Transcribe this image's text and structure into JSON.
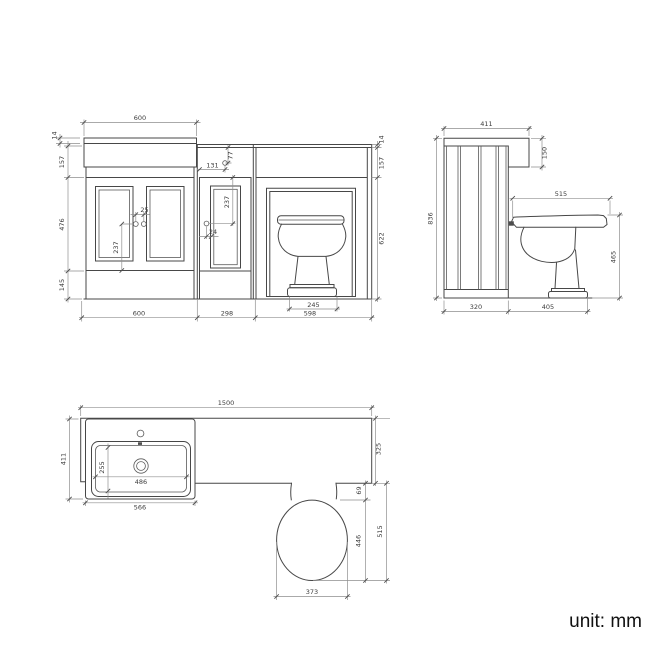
{
  "drawing": {
    "unit_label": "unit: mm",
    "front_view": {
      "top_counter_width": "600",
      "counter_thickness_left": "14",
      "upstand_height": "157",
      "door_zone_height": "476",
      "plinth_height": "145",
      "knob_spacing": "25",
      "knob_to_plinth": "237",
      "mid_knob_offset_h": "131",
      "mid_knob_offset_v": "77",
      "mid_door_knob_drop": "237",
      "mid_knob_edge_offset": "24",
      "counter_thickness_right": "14",
      "counter_band_right": "157",
      "body_height_right": "622",
      "toilet_base_width": "245",
      "section_width_left": "600",
      "section_width_mid": "298",
      "section_width_right": "598"
    },
    "side_view": {
      "counter_depth": "411",
      "counter_return_drop": "150",
      "overall_height": "836",
      "seat_projection": "515",
      "seat_height": "465",
      "panel_depth": "320",
      "toilet_zone_depth": "405"
    },
    "plan_view": {
      "overall_width": "1500",
      "basin_unit_depth": "411",
      "basin_inner_depth": "255",
      "basin_inner_width": "486",
      "basin_unit_width": "566",
      "counter_depth": "325",
      "seat_gap": "69",
      "pan_length": "446",
      "pan_overall_length": "515",
      "pan_width": "373"
    }
  }
}
